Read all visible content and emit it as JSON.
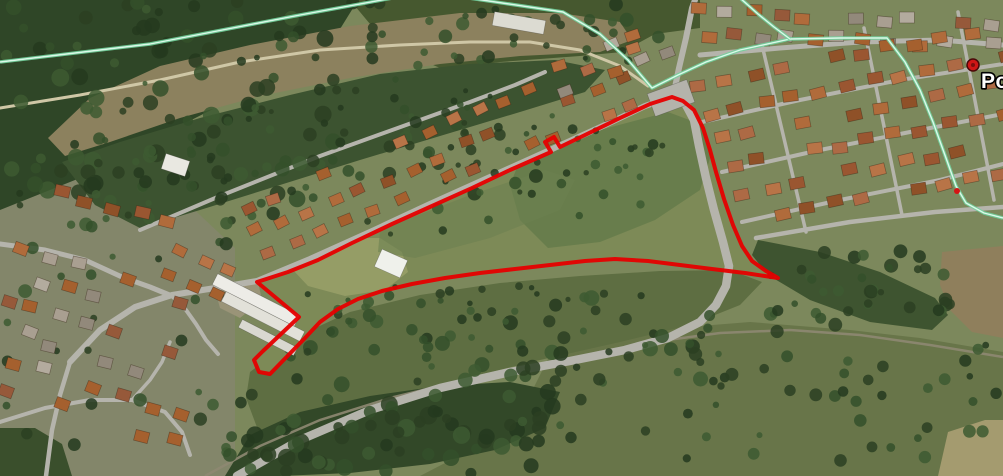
{
  "marker": {
    "label": "Por",
    "x": 973,
    "y": 65,
    "radius": 6,
    "label_x": 981,
    "label_y": 88,
    "dot_color": "#cf1616",
    "dot_ring": "#4a0909",
    "dot_core": "#7e0d0d",
    "label_fill": "#ffffff",
    "label_outline": "#000000"
  },
  "waypoint": {
    "x": 957,
    "y": 191,
    "r": 3,
    "color": "#d41414"
  },
  "parcel": {
    "stroke": "#e60000",
    "width": 4,
    "fill": "#7d8a57",
    "path": "M257,282 L299,317 L263,351 L254,360 L259,372 L270,374 L305,338 L320,322 L338,309 L358,299 L382,291 L412,284 L445,278 L480,273 L515,269 L550,265 L585,261 L615,259 L648,261 L680,265 L712,269 L745,273 L778,278 L766,271 L752,261 L742,246 L733,225 L724,199 L716,172 L710,150 L703,128 L694,110 L683,101 L672,97 L650,104 L620,118 L585,135 L560,147 L554,137 L545,142 L551,152 L510,170 L472,188 L432,206 L392,224 L352,243 L318,260 L288,272 Z"
  },
  "boundary_line": {
    "casing": "#72d09c",
    "core": "#dcf9e9",
    "w_casing": 3.5,
    "w_core": 1.4,
    "segments": [
      "M0,62 L150,44 L300,15 L398,-3",
      "M462,-3 L563,12 L600,34 L628,60 L652,88 L678,75 L706,62 L740,50 L790,39 L840,38 L887,38 L905,62 L920,90 L933,122 L946,158 L956,186 L966,203 L984,213 L1003,218",
      "M740,-2 L758,14 L774,27 L790,39"
    ]
  },
  "railway": {
    "d": "M205,476 L260,446 L320,420 L390,398 L460,381 L530,368 L600,352 L660,341 L720,333 L790,330 L860,335 L930,345 L1003,357",
    "w": 2.5,
    "color": "#8e8872"
  },
  "roads": [
    {
      "name": "main-road-curve",
      "d": "M237,476 L300,440 L370,410 L440,388 L510,372 L570,361 L625,350 L668,338 L700,322 L716,305 L726,286 L729,266 L723,242 L714,210 L706,178 L699,146 L694,120 L685,103 L673,97",
      "w": 8.5
    },
    {
      "name": "town-north-road",
      "d": "M673,97 L679,68 L686,38 L692,8 L695,0",
      "w": 6
    },
    {
      "name": "west-road",
      "d": "M70,362 L100,330 L135,307 L172,295 L215,288 L257,281 L310,259 L370,232 L430,204 L490,177 L550,150 L605,125 L645,106 L672,97",
      "w": 6
    },
    {
      "name": "upper-street",
      "d": "M140,230 L220,196 L320,156 L420,120 L470,102 L515,85 L545,72",
      "w": 4
    },
    {
      "name": "warehouse-lane",
      "d": "M172,296 L186,310 L196,324 L206,340 L218,354",
      "w": 4
    },
    {
      "name": "left-road-1",
      "d": "M0,244 L45,250 L85,260 L122,277 L150,287 L172,296",
      "w": 5
    },
    {
      "name": "left-road-2",
      "d": "M70,362 L60,395 L52,430 L46,476",
      "w": 4.5
    },
    {
      "name": "left-road-3",
      "d": "M0,422 L45,408 L90,400 L132,400 L165,412 L182,432 L190,455",
      "w": 4
    },
    {
      "name": "left-road-4",
      "d": "M132,400 L150,380 L162,362 L170,342",
      "w": 3.5
    },
    {
      "name": "estate-street-1",
      "d": "M702,122 L800,100 L900,80 L1003,64",
      "w": 4
    },
    {
      "name": "estate-street-2",
      "d": "M722,172 L820,150 L920,130 L1003,114",
      "w": 4
    },
    {
      "name": "estate-street-3",
      "d": "M742,222 L840,200 L940,180 L1003,164",
      "w": 4
    },
    {
      "name": "estate-south-road",
      "d": "M756,238 L850,222 L935,212 L1003,207",
      "w": 4.5
    },
    {
      "name": "estate-cross-1",
      "d": "M762,45 L806,232",
      "w": 3.5
    },
    {
      "name": "estate-cross-2",
      "d": "M864,28 L902,215",
      "w": 3.5
    },
    {
      "name": "estate-cross-3",
      "d": "M958,12 L994,200",
      "w": 3.5
    },
    {
      "name": "oldtown-street",
      "d": "M700,55 L780,48 L860,42 L940,40 L1003,45",
      "w": 5
    },
    {
      "name": "clearing-trail",
      "d": "M0,108 L80,95 L160,80 L240,62 L320,50 L400,45 L470,42 L530,42 L580,50 L620,66 L648,86",
      "w": 3,
      "color": "#cfc7a6"
    }
  ],
  "terrain": [
    {
      "name": "base",
      "d": "M0,0 H1003 V476 H0 Z",
      "fill": "#7c885c"
    },
    {
      "name": "left-town-ground",
      "d": "M0,140 L95,132 L150,168 L200,215 L235,248 L235,476 L0,476 Z",
      "fill": "#83866a"
    },
    {
      "name": "bottom-right-scrub",
      "d": "M555,345 L650,330 L750,322 L850,330 L920,338 L1003,352 L1003,476 L420,476 L470,450 L520,415 Z",
      "fill": "#687549"
    },
    {
      "name": "south-scrub",
      "d": "M250,372 L300,335 L350,312 L420,295 L500,283 L580,276 L660,271 L730,270 L762,282 L740,305 L690,325 L620,342 L540,360 L450,382 L360,412 L285,448 L258,430 L246,398 Z",
      "fill": "#5e6e42"
    },
    {
      "name": "bottom-forest",
      "d": "M225,476 L250,435 L300,412 L370,396 L440,386 L510,382 L560,392 L545,428 L495,450 L430,464 L350,473 L280,476 Z",
      "fill": "#324828"
    },
    {
      "name": "bottom-left-trees",
      "d": "M0,428 L35,428 L62,444 L72,476 L0,476 Z",
      "fill": "#3a4f2c"
    },
    {
      "name": "top-left-forest",
      "d": "M0,0 L358,0 L332,42 L282,74 L215,108 L148,142 L75,180 L0,210 Z",
      "fill": "#2f4627"
    },
    {
      "name": "upper-forest-band",
      "d": "M350,0 L700,0 L700,28 L655,34 L622,52 L580,56 L500,62 L445,70 L402,52 L370,24 Z",
      "fill": "#46582f"
    },
    {
      "name": "clearing",
      "d": "M48,138 L90,98 L160,66 L250,45 L350,26 L460,13 L560,13 L620,22 L632,40 L600,52 L520,56 L440,64 L350,78 L260,96 L180,118 L110,142 L65,156 Z",
      "fill": "#8c815e"
    },
    {
      "name": "mid-forest-wedge",
      "d": "M62,162 L120,142 L200,118 L290,95 L380,74 L470,64 L555,60 L605,70 L585,92 L520,112 L440,136 L360,160 L280,185 L200,210 L140,228 L95,205 Z",
      "fill": "#3c5330"
    },
    {
      "name": "right-strip-trees",
      "d": "M758,240 L820,252 L880,272 L935,298 L948,315 L932,330 L870,322 L810,300 L768,275 L752,255 Z",
      "fill": "#3e5430"
    },
    {
      "name": "brown-patch",
      "d": "M942,252 L1003,246 L1003,338 L972,332 L950,310 L940,285 Z",
      "fill": "#8f7f5c"
    },
    {
      "name": "tawny-corner",
      "d": "M948,432 L985,420 L1003,420 L1003,476 L938,476 Z",
      "fill": "#a49b6f"
    },
    {
      "name": "dirt-lot",
      "d": "M215,290 L258,282 L262,300 L240,318 L220,308 Z",
      "fill": "#9a9478"
    }
  ],
  "field_blotches": [
    {
      "name": "pale-west",
      "d": "M295,255 L340,238 L380,238 L402,252 L408,272 L385,290 L345,296 L308,286 L293,270 Z",
      "fill": "#99a069",
      "opacity": 0.85
    },
    {
      "name": "pale-south",
      "d": "M335,305 L420,287 L510,277 L580,272 L612,276 L596,287 L500,295 L415,305 L355,318 Z",
      "fill": "#8e9560",
      "opacity": 0.7
    },
    {
      "name": "dark-center",
      "d": "M520,160 L600,130 L668,112 L700,124 L712,152 L700,190 L655,220 L600,242 L548,248 L520,220 L510,185 Z",
      "fill": "#5f7847",
      "opacity": 0.7
    },
    {
      "name": "mid-green",
      "d": "M380,230 L470,195 L545,170 L575,180 L560,210 L490,238 L415,258 L378,252 Z",
      "fill": "#6d8150",
      "opacity": 0.6
    }
  ],
  "tree_groups": [
    {
      "name": "forest-topleft-texture",
      "x": 0,
      "y": 0,
      "w": 340,
      "h": 200,
      "n": 90,
      "rmin": 4,
      "rmax": 9
    },
    {
      "name": "forest-band-texture",
      "x": 330,
      "y": 0,
      "w": 330,
      "h": 66,
      "n": 38,
      "rmin": 3,
      "rmax": 7
    },
    {
      "name": "clearing-specks",
      "x": 90,
      "y": 45,
      "w": 500,
      "h": 85,
      "n": 22,
      "rmin": 2,
      "rmax": 4
    },
    {
      "name": "mid-wedge-texture",
      "x": 70,
      "y": 120,
      "w": 480,
      "h": 105,
      "n": 55,
      "rmin": 3,
      "rmax": 7
    },
    {
      "name": "south-scrub-trees",
      "x": 280,
      "y": 295,
      "w": 430,
      "h": 90,
      "n": 60,
      "rmin": 3,
      "rmax": 8
    },
    {
      "name": "bottom-forest-trees",
      "x": 225,
      "y": 390,
      "w": 330,
      "h": 84,
      "n": 70,
      "rmin": 4,
      "rmax": 9
    },
    {
      "name": "bottom-right-trees",
      "x": 560,
      "y": 335,
      "w": 440,
      "h": 138,
      "n": 55,
      "rmin": 3,
      "rmax": 7
    },
    {
      "name": "right-strip-canopy",
      "x": 765,
      "y": 248,
      "w": 185,
      "h": 85,
      "n": 40,
      "rmin": 3,
      "rmax": 7
    },
    {
      "name": "left-town-trees",
      "x": 0,
      "y": 150,
      "w": 230,
      "h": 300,
      "n": 35,
      "rmin": 3,
      "rmax": 7
    },
    {
      "name": "parcel-south-clumps",
      "x": 300,
      "y": 282,
      "w": 310,
      "h": 40,
      "n": 22,
      "rmin": 2.5,
      "rmax": 5
    },
    {
      "name": "parcel-north-hedge",
      "x": 430,
      "y": 120,
      "w": 240,
      "h": 70,
      "n": 18,
      "rmin": 2.5,
      "rmax": 5.5
    },
    {
      "name": "gardens-strip",
      "x": 250,
      "y": 95,
      "w": 400,
      "h": 140,
      "n": 30,
      "rmin": 2.5,
      "rmax": 5
    }
  ],
  "tree_colors": [
    "#2b4022",
    "#34502a",
    "#253a1e",
    "#3d5a31"
  ],
  "palettes": {
    "terracotta": [
      "#a5602e",
      "#b06b3b",
      "#9a5631",
      "#b87447",
      "#8f5128",
      "#ad6a45"
    ],
    "mixed": [
      "#a5602e",
      "#b06b3b",
      "#96593a",
      "#b3ab9e",
      "#92897b",
      "#a99f91"
    ]
  },
  "house_clusters": [
    {
      "name": "right-town-old",
      "origin": [
        694,
        6
      ],
      "step": [
        26,
        1
      ],
      "row_step": [
        7,
        23
      ],
      "per_row": 12,
      "rows": 2,
      "size": [
        15,
        11
      ],
      "angle": 4,
      "jitter": 4,
      "skip": 0.12,
      "palette": "mixed"
    },
    {
      "name": "right-town-estate",
      "origin": [
        692,
        80
      ],
      "step": [
        27,
        -5.4
      ],
      "row_step": [
        11,
        27
      ],
      "per_row": 12,
      "rows": 6,
      "size": [
        15,
        11
      ],
      "angle": -11,
      "jitter": 3.5,
      "skip": 0.15,
      "palette": "terracotta"
    },
    {
      "name": "roadside-strip",
      "origin": [
        262,
        252
      ],
      "step": [
        26,
        -11
      ],
      "row_step": [
        -11,
        -24
      ],
      "per_row": 16,
      "rows": 3,
      "size": [
        13,
        10
      ],
      "angle": -23,
      "jitter": 4.5,
      "skip": 0.3,
      "palette": "terracotta"
    },
    {
      "name": "left-town",
      "origin": [
        15,
        240
      ],
      "step": [
        27,
        9
      ],
      "row_step": [
        -8,
        27
      ],
      "per_row": 8,
      "rows": 6,
      "size": [
        14,
        11
      ],
      "angle": 17,
      "jitter": 5,
      "skip": 0.3,
      "palette": "mixed"
    },
    {
      "name": "left-town-upper",
      "origin": [
        52,
        188
      ],
      "step": [
        27,
        7
      ],
      "row_step": [
        0,
        26
      ],
      "per_row": 5,
      "rows": 1,
      "size": [
        15,
        11
      ],
      "angle": 14,
      "jitter": 3,
      "skip": 0.1,
      "palette": "terracotta"
    },
    {
      "name": "mid-cluster",
      "origin": [
        175,
        245
      ],
      "step": [
        24,
        10
      ],
      "row_step": [
        -10,
        24
      ],
      "per_row": 3,
      "rows": 2,
      "size": [
        13,
        10
      ],
      "angle": 22,
      "jitter": 3,
      "skip": 0.15,
      "palette": "terracotta"
    },
    {
      "name": "near-junction",
      "origin": [
        552,
        60
      ],
      "step": [
        25,
        -9
      ],
      "row_step": [
        9,
        24
      ],
      "per_row": 5,
      "rows": 2,
      "size": [
        14,
        10
      ],
      "angle": -20,
      "jitter": 3,
      "skip": 0.2,
      "palette": "mixed"
    }
  ],
  "buildings": [
    {
      "name": "warehouse-roof",
      "x": 210,
      "y": 294,
      "w": 92,
      "h": 12,
      "angle": 27,
      "fill": "#edece7"
    },
    {
      "name": "warehouse-roof",
      "x": 219,
      "y": 311,
      "w": 88,
      "h": 11,
      "angle": 27,
      "fill": "#e2e1d9"
    },
    {
      "name": "warehouse-roof",
      "x": 237,
      "y": 333,
      "w": 62,
      "h": 9,
      "angle": 27,
      "fill": "#d9d8d0"
    },
    {
      "name": "field-tent",
      "x": 377,
      "y": 254,
      "w": 28,
      "h": 19,
      "angle": 24,
      "fill": "#eff1eb"
    },
    {
      "name": "white-building",
      "x": 493,
      "y": 16,
      "w": 52,
      "h": 14,
      "angle": 10,
      "fill": "#dcdbd2"
    },
    {
      "name": "white-building",
      "x": 163,
      "y": 157,
      "w": 25,
      "h": 16,
      "angle": 18,
      "fill": "#e9e8e1"
    },
    {
      "name": "junction-pad",
      "x": 650,
      "y": 86,
      "w": 42,
      "h": 24,
      "angle": -20,
      "fill": "#b4b3ab"
    }
  ],
  "road_color_default": "#b5b4ac"
}
